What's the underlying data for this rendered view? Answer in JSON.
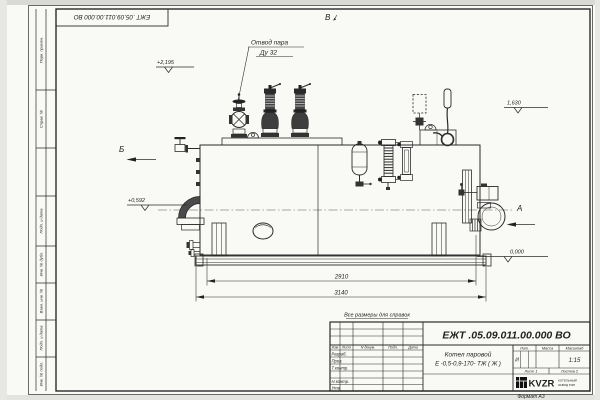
{
  "sheet": {
    "corner_stamp": "ЕЖТ .05.09.011.00.000 ВО",
    "format_label": "Формат А3",
    "margin_labels": [
      "Перв. примен.",
      "Справ. №",
      "Подп. и дата",
      "Инв. № дубл.",
      "Взам. инв. №",
      "Подп. и дата",
      "Инв. № подл."
    ]
  },
  "drawing": {
    "steam_outlet_label": {
      "line1": "Отвод пара",
      "line2": "Ду 32"
    },
    "views": {
      "top": "В",
      "left": "Б",
      "right": "А"
    },
    "elevations": {
      "valve_top": "+2,195",
      "smoke_outlet": "+0,592",
      "right_level": "1,630",
      "ground": "0,000"
    },
    "dimensions": {
      "drum_length": "2910",
      "overall_length": "3140"
    }
  },
  "title_block": {
    "note": "Все размеры для справок",
    "doc_number": "ЕЖТ .05.09.011.00.000 ВО",
    "name_line1": "Котел паровой",
    "name_line2": "Е -0,5-0,9-170- ТЖ ( Ж )",
    "col_headers": [
      "Изм",
      "Лист",
      "N докум.",
      "Подп.",
      "Дата"
    ],
    "row_labels": [
      "Разраб.",
      "Пров.",
      "Т.контр.",
      "Н.контр.",
      "Утв."
    ],
    "lit_header": "Лит.",
    "mass_header": "Масса",
    "scale_header": "Масштаб",
    "lit_value": "И",
    "scale_value": "1:15",
    "sheet_info": "Лист 1",
    "sheets_info": "Листов 2",
    "logo": {
      "text": "KVZR",
      "sub1": "КОТЕЛЬНЫЙ",
      "sub2": "ЗАВОД РЭП"
    }
  }
}
